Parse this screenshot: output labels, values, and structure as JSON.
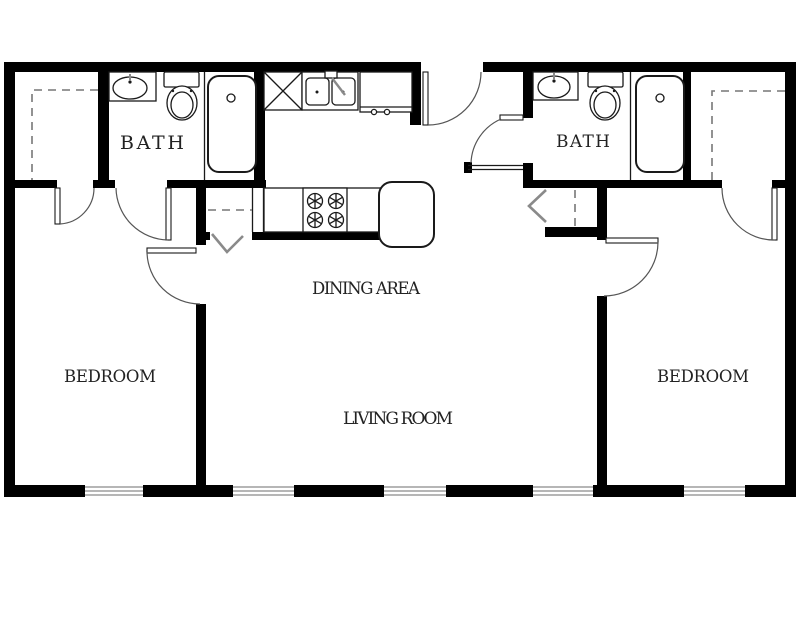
{
  "colors": {
    "wall": "#000000",
    "line": "#1a1a1a",
    "arc": "#555555",
    "accent_gray": "#8a8a8a",
    "dash": "#777777",
    "background": "#ffffff"
  },
  "rooms": {
    "bath_left": {
      "label": "BATH"
    },
    "bath_right": {
      "label": "BATH"
    },
    "dining_area": {
      "label": "DINING AREA"
    },
    "living_room": {
      "label": "LIVING ROOM"
    },
    "bedroom_left": {
      "label": "BEDROOM"
    },
    "bedroom_right": {
      "label": "BEDROOM"
    }
  },
  "fixtures": [
    "bathroom-sink",
    "toilet",
    "bathtub",
    "kitchen-double-sink",
    "dishwasher",
    "refrigerator",
    "stove",
    "dining-table",
    "window",
    "hinged-door",
    "bifold-closet-door",
    "closet-shelf-dashed"
  ]
}
